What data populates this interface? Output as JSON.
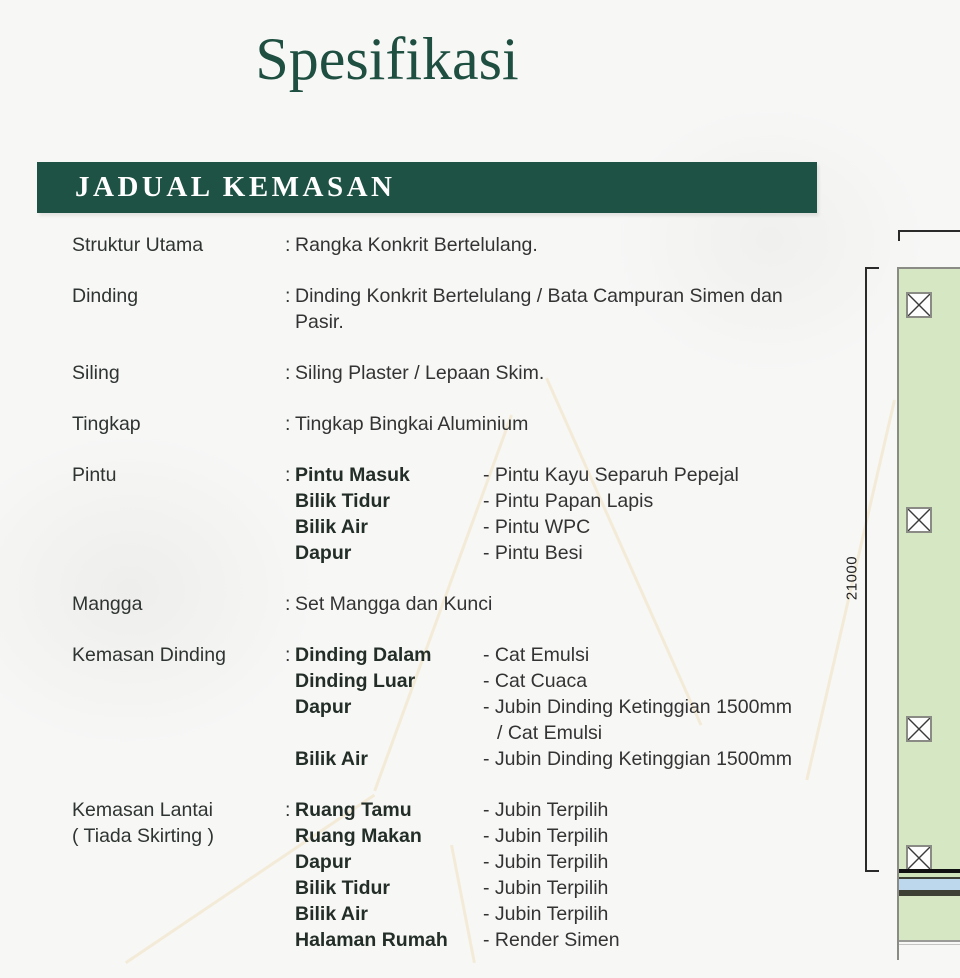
{
  "page": {
    "title": "Spesifikasi",
    "section_header": "JADUAL KEMASAN"
  },
  "schedule": {
    "colon": ":",
    "rows": [
      {
        "label": "Struktur Utama",
        "value": "Rangka Konkrit Bertelulang."
      },
      {
        "label": "Dinding",
        "value": "Dinding Konkrit Bertelulang / Bata Campuran Simen dan Pasir."
      },
      {
        "label": "Siling",
        "value": "Siling Plaster / Lepaan Skim."
      },
      {
        "label": "Tingkap",
        "value": "Tingkap Bingkai Aluminium"
      },
      {
        "label": "Pintu",
        "items": [
          {
            "name": "Pintu Masuk",
            "value": "- Pintu Kayu Separuh Pepejal"
          },
          {
            "name": "Bilik Tidur",
            "value": "- Pintu Papan Lapis"
          },
          {
            "name": "Bilik Air",
            "value": "- Pintu WPC"
          },
          {
            "name": "Dapur",
            "value": "- Pintu Besi"
          }
        ]
      },
      {
        "label": "Mangga",
        "value": "Set Mangga dan Kunci"
      },
      {
        "label": "Kemasan Dinding",
        "items": [
          {
            "name": "Dinding Dalam",
            "value": "- Cat Emulsi"
          },
          {
            "name": "Dinding Luar",
            "value": "- Cat Cuaca"
          },
          {
            "name": "Dapur",
            "value": "- Jubin Dinding Ketinggian 1500mm"
          },
          {
            "name": "",
            "value": "/ Cat Emulsi"
          },
          {
            "name": "Bilik Air",
            "value": "- Jubin Dinding Ketinggian 1500mm"
          }
        ]
      },
      {
        "label": "Kemasan Lantai",
        "sublabel": "( Tiada Skirting )",
        "items": [
          {
            "name": "Ruang Tamu",
            "value": "- Jubin Terpilih"
          },
          {
            "name": "Ruang Makan",
            "value": "- Jubin Terpilih"
          },
          {
            "name": "Dapur",
            "value": "- Jubin Terpilih"
          },
          {
            "name": "Bilik Tidur",
            "value": "- Jubin Terpilih"
          },
          {
            "name": "Bilik Air",
            "value": "- Jubin Terpilih"
          },
          {
            "name": "Halaman Rumah",
            "value": "- Render Simen"
          }
        ]
      }
    ]
  },
  "plan": {
    "dimension_label": "21000",
    "colors": {
      "plot_fill": "#d6e7c3",
      "water_strip": "#bdd8ec",
      "line_dark": "#3c4035",
      "border_gray": "#8b8b85"
    }
  },
  "theme": {
    "accent_green": "#1e5244",
    "title_green": "#1e4f40",
    "text_dark": "#333333"
  }
}
